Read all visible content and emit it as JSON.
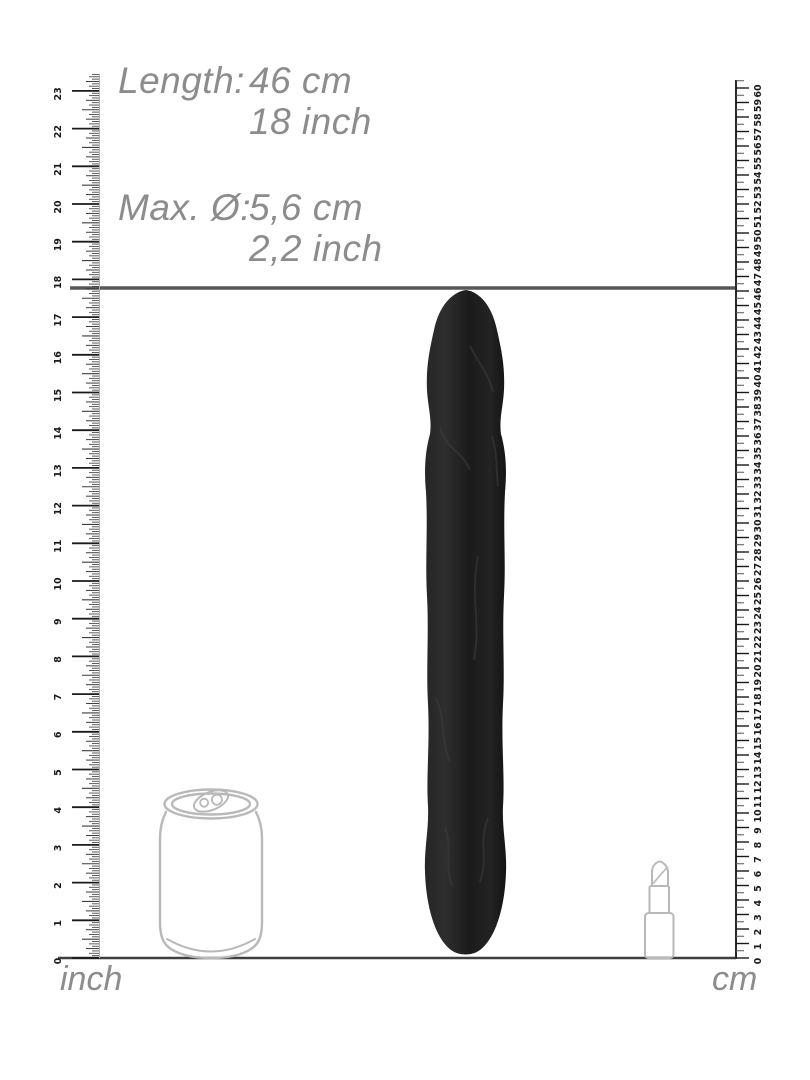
{
  "page": {
    "background_color": "#ffffff"
  },
  "annotations": {
    "text_color": "#8c8c8c",
    "length": {
      "label": "Length:",
      "metric": "46 cm",
      "imperial": "18 inch"
    },
    "diameter": {
      "label": "Max. Ø:",
      "metric": "5,6 cm",
      "imperial": "2,2 inch"
    }
  },
  "measurement_line": {
    "cm": 46,
    "inch": 18
  },
  "rulers": {
    "inch": {
      "unit_label": "inch",
      "min": 0,
      "max": 23,
      "subdivisions_per_unit": 16,
      "numbers": [
        0,
        1,
        2,
        3,
        4,
        5,
        6,
        7,
        8,
        9,
        10,
        11,
        12,
        13,
        14,
        15,
        16,
        17,
        18,
        19,
        20,
        21,
        22,
        23
      ]
    },
    "cm": {
      "unit_label": "cm",
      "min": 0,
      "max": 60,
      "subdivisions_per_unit": 2,
      "numbers": [
        0,
        1,
        2,
        3,
        4,
        5,
        6,
        7,
        8,
        9,
        10,
        11,
        12,
        13,
        14,
        15,
        16,
        17,
        18,
        19,
        20,
        21,
        22,
        23,
        24,
        25,
        26,
        27,
        28,
        29,
        30,
        31,
        32,
        33,
        34,
        35,
        36,
        37,
        38,
        39,
        40,
        41,
        42,
        43,
        44,
        45,
        46,
        47,
        48,
        49,
        50,
        51,
        52,
        53,
        54,
        55,
        56,
        57,
        58,
        59,
        60
      ]
    }
  },
  "product": {
    "silhouette_color": "#1f1f1f"
  },
  "reference_objects": {
    "outline_color": "#b9b9b9",
    "items": [
      "soda-can",
      "lipstick"
    ]
  }
}
